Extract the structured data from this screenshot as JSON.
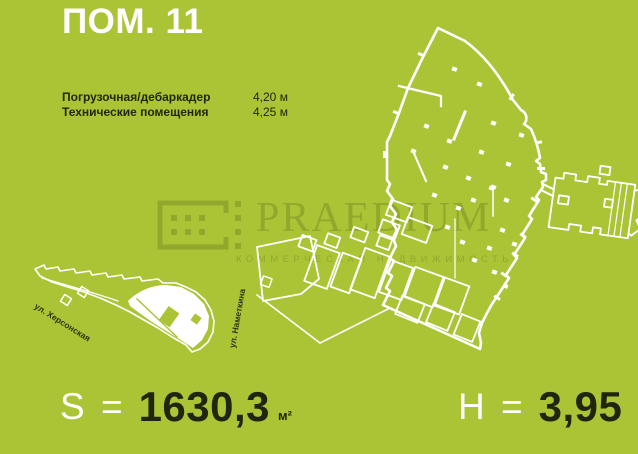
{
  "title": "ПОМ. 11",
  "specs": [
    {
      "label": "Погрузочная/дебаркадер",
      "value": "4,20 м"
    },
    {
      "label": "Технические помещения",
      "value": "4,25 м"
    }
  ],
  "metrics": {
    "area_prefix": "S =",
    "area_value": "1630,3",
    "area_unit": "м²",
    "height_prefix": "H =",
    "height_value": "3,95"
  },
  "watermark": {
    "brand": "PRAEDIUM",
    "tagline": "КОММЕРЧЕСКАЯ НЕДВИЖИМОСТЬ"
  },
  "minimap": {
    "street_left": "ул. Херсонская",
    "street_right": "ул. Наметкина"
  },
  "colors": {
    "background": "#abc436",
    "ink": "#20260e",
    "plan_line": "#ffffff",
    "watermark": "#7d9226"
  }
}
